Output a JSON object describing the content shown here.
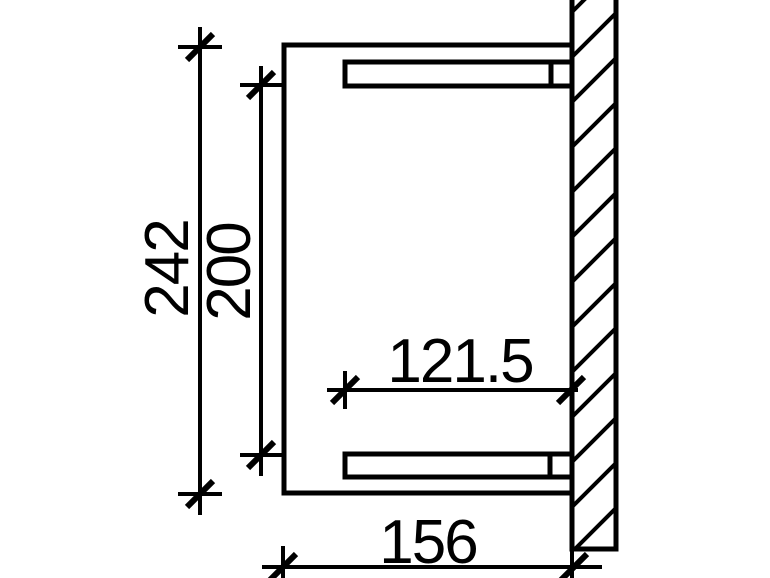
{
  "drawing": {
    "background_color": "#ffffff",
    "line_color": "#000000"
  },
  "dimensions": {
    "overall_width": {
      "label": "242"
    },
    "beam_spacing": {
      "label": "200"
    },
    "beam_length": {
      "label": "121.5"
    },
    "projection": {
      "label": "156"
    }
  }
}
